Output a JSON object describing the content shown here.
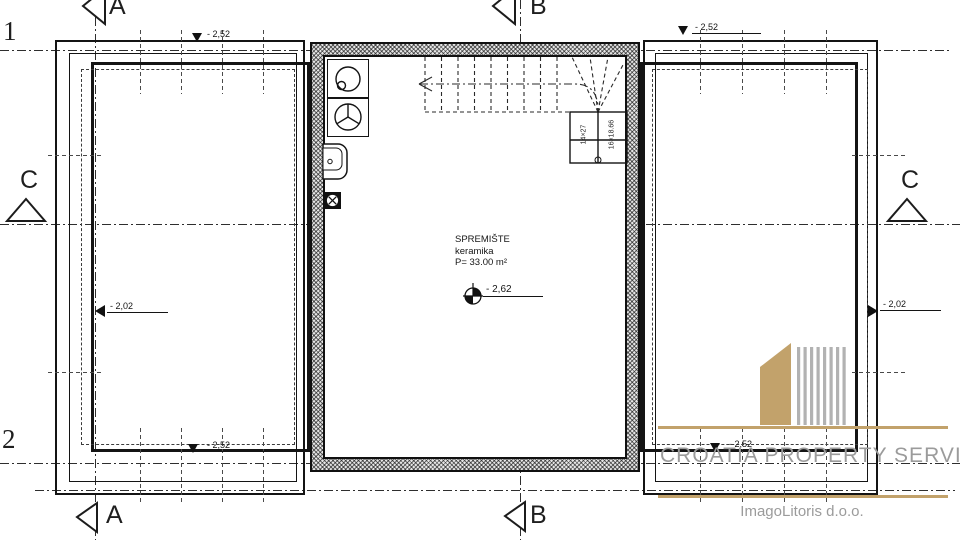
{
  "drawing": {
    "grid": {
      "row_1": "1",
      "row_2": "2",
      "section_a": "A",
      "section_b": "B",
      "section_c": "C"
    },
    "room": {
      "name": "SPREMIŠTE",
      "finish": "keramika",
      "area": "P= 33.00 m²"
    },
    "levels": {
      "storage": "- 2,62",
      "terrace_left": "- 2,02",
      "terrace_right": "- 2,02",
      "sill_top_left": "- 2,52",
      "sill_top_right": "- 2,52",
      "sill_bottom_left": "- 2,52",
      "sill_bottom_right": "- 2,52"
    },
    "stairs": {
      "run": "14×27",
      "rise": "16×18.66"
    }
  },
  "branding": {
    "company": "CROATIA PROPERTY SERVICE",
    "studio": "ImagoLitoris d.o.o.",
    "accent_color": "#C2A26B",
    "text_color": "#9B9B9B"
  }
}
